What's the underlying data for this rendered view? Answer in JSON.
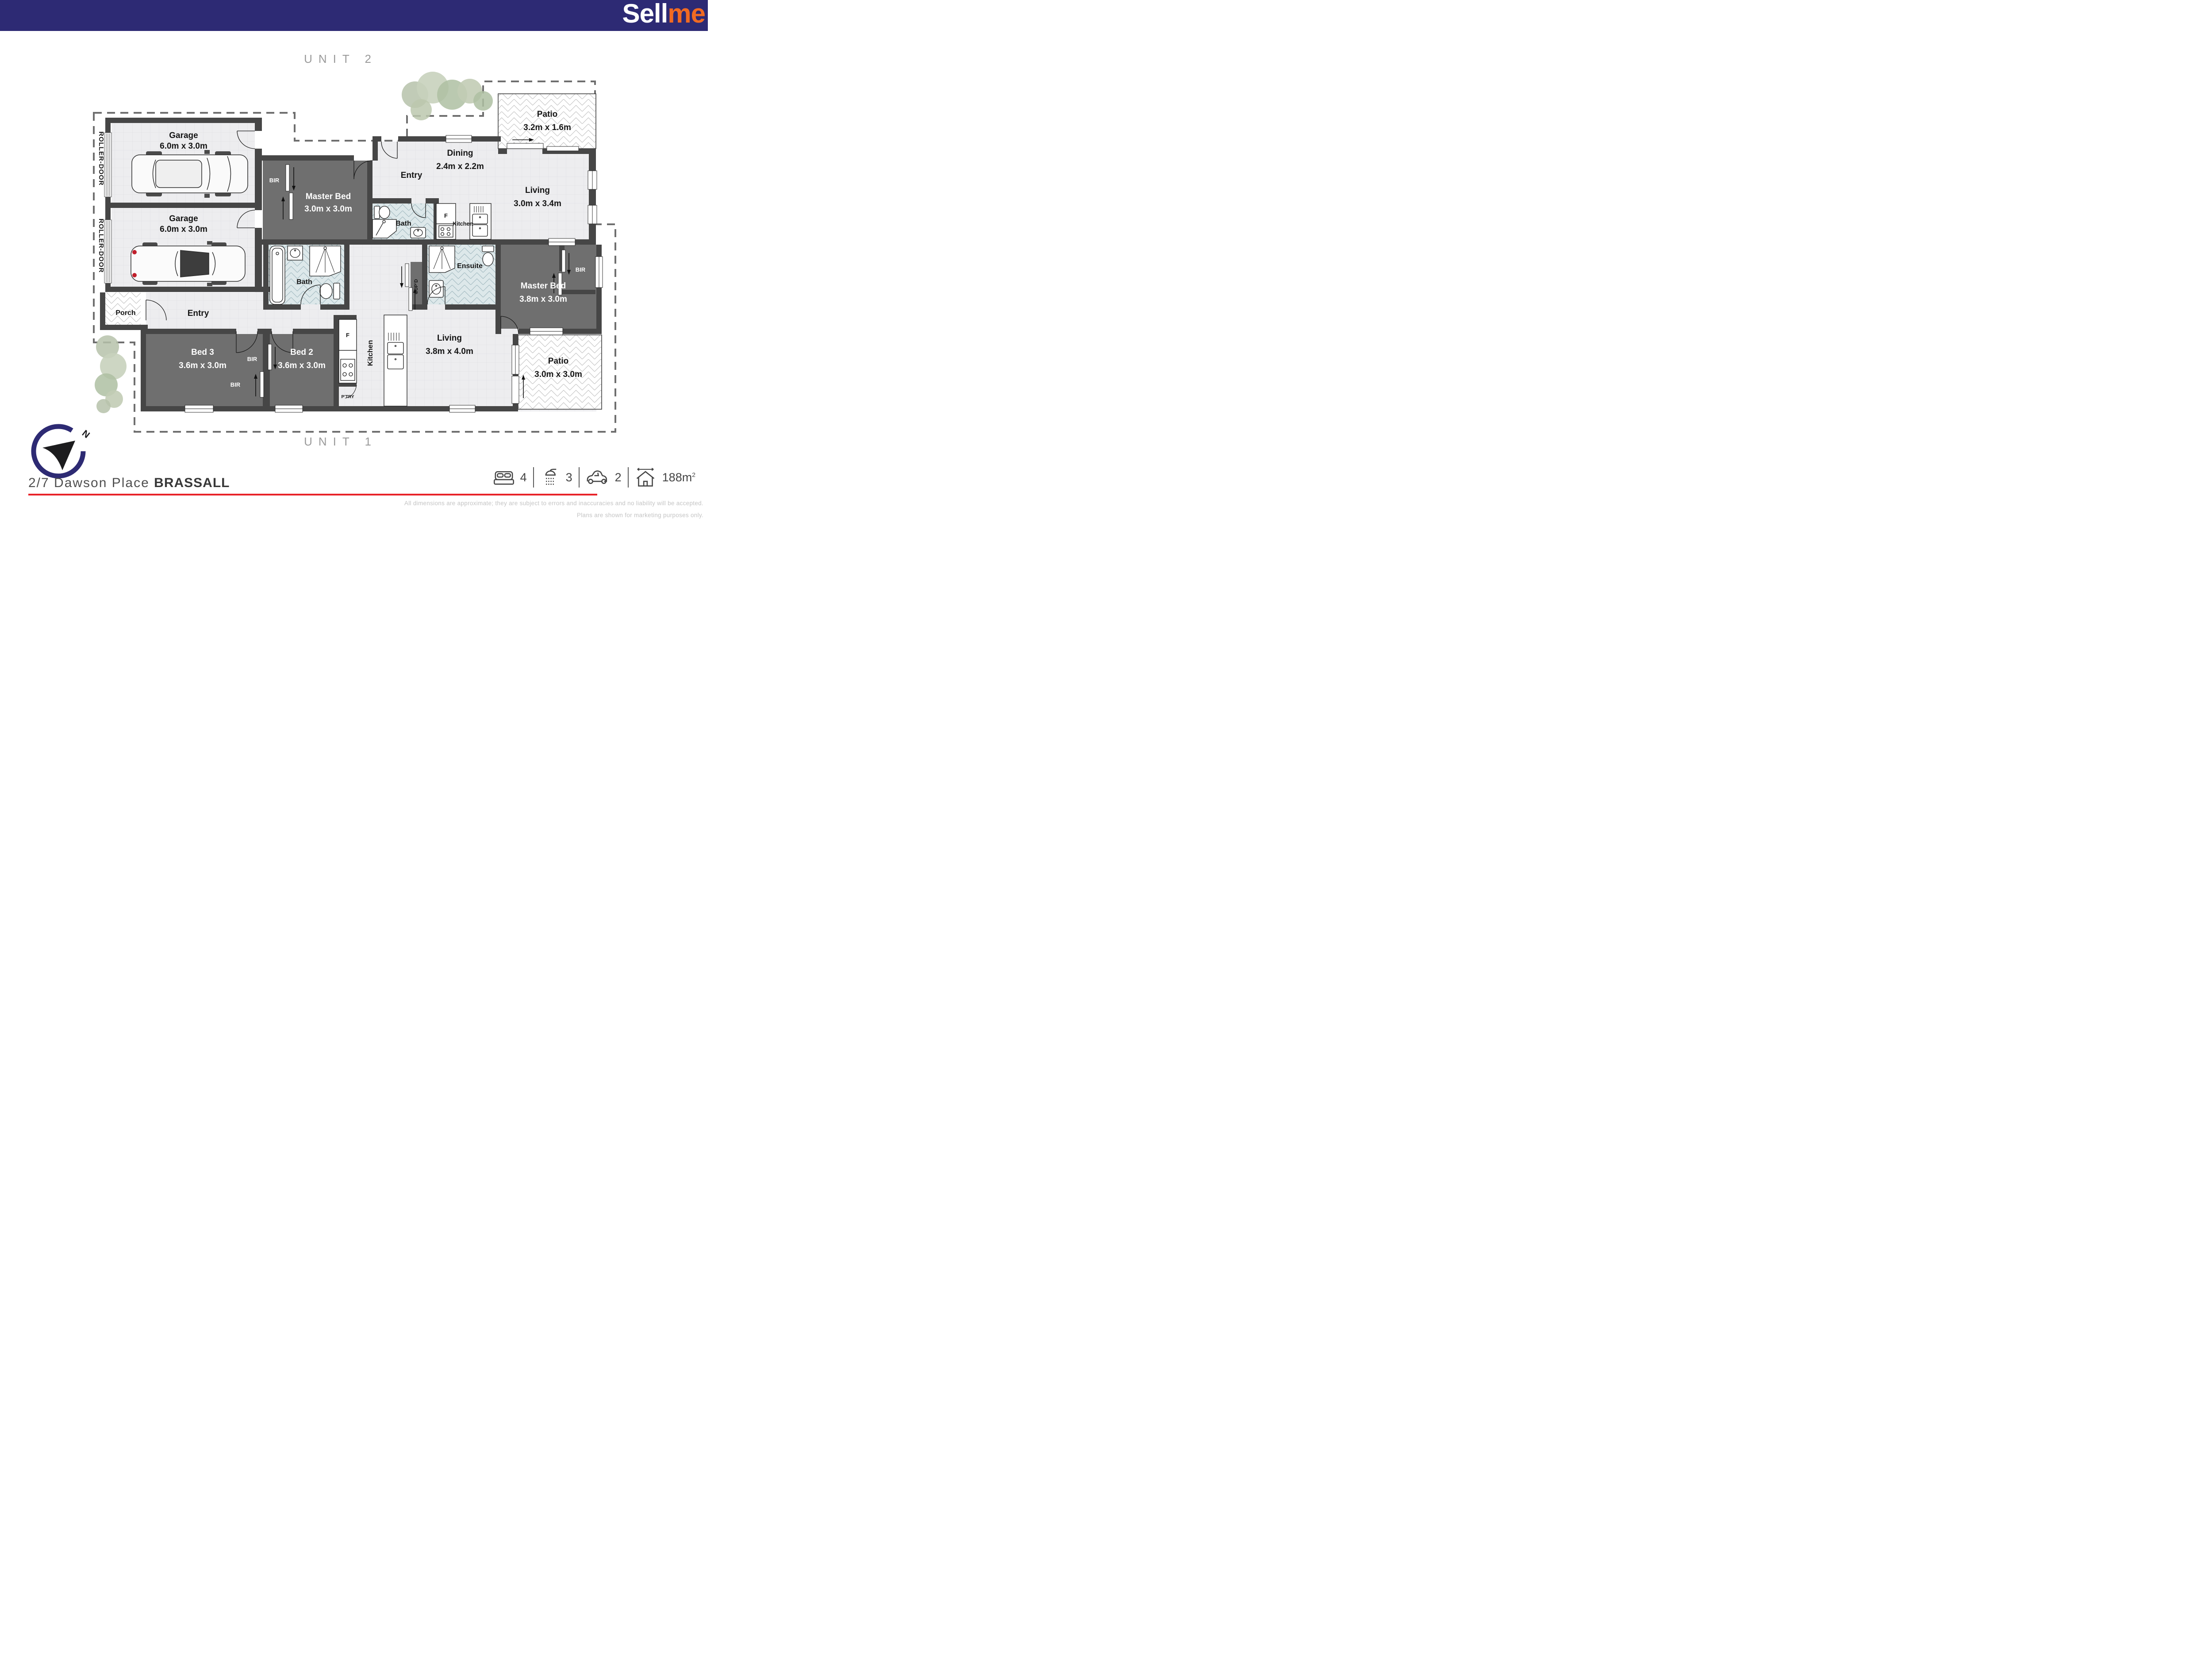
{
  "header": {
    "logo_sell": "Sell",
    "logo_me": "me"
  },
  "unit2": {
    "title": "UNIT 2",
    "roller_door_1": "ROLLER-DOOR",
    "roller_door_2": "ROLLER-DOOR",
    "garage1_name": "Garage",
    "garage1_dims": "6.0m x 3.0m",
    "garage2_name": "Garage",
    "garage2_dims": "6.0m x 3.0m",
    "bir": "BIR",
    "master_name": "Master Bed",
    "master_dims": "3.0m x 3.0m",
    "entry": "Entry",
    "bath": "Bath",
    "fridge": "F",
    "kitchen": "Kitchen",
    "dining_name": "Dining",
    "dining_dims": "2.4m x 2.2m",
    "living_name": "Living",
    "living_dims": "3.0m x 3.4m",
    "patio_name": "Patio",
    "patio_dims": "3.2m x 1.6m"
  },
  "unit1": {
    "title": "UNIT 1",
    "porch": "Porch",
    "entry": "Entry",
    "bed3_name": "Bed 3",
    "bed3_dims": "3.6m x 3.0m",
    "bed2_name": "Bed 2",
    "bed2_dims": "3.6m x 3.0m",
    "bir_a": "BIR",
    "bir_b": "BIR",
    "bath": "Bath",
    "cupd": "CUP’D",
    "ensuite": "Ensuite",
    "master_name": "Master Bed",
    "master_dims": "3.8m x 3.0m",
    "master_bir": "BIR",
    "fridge": "F",
    "kitchen": "Kitchen",
    "pantry": "P’TRY",
    "living_name": "Living",
    "living_dims": "3.8m x 4.0m",
    "patio_name": "Patio",
    "patio_dims": "3.0m x 3.0m"
  },
  "compass": {
    "north": "N"
  },
  "footer": {
    "address_street": "2/7 Dawson Place",
    "address_suburb": "BRASSALL",
    "stats": {
      "beds": "4",
      "baths": "3",
      "cars": "2",
      "area_value": "188m",
      "area_sup": "2"
    },
    "disclaimer_line1": "All dimensions are approximate; they are subject to errors and inaccuracies and no liability will be accepted.",
    "disclaimer_line2": "Plans are shown for marketing purposes only."
  },
  "colors": {
    "brand_navy": "#2d2a74",
    "brand_orange": "#f16a22",
    "accent_red": "#e82329",
    "wall": "#464646",
    "carpet": "#6f6f6f"
  }
}
